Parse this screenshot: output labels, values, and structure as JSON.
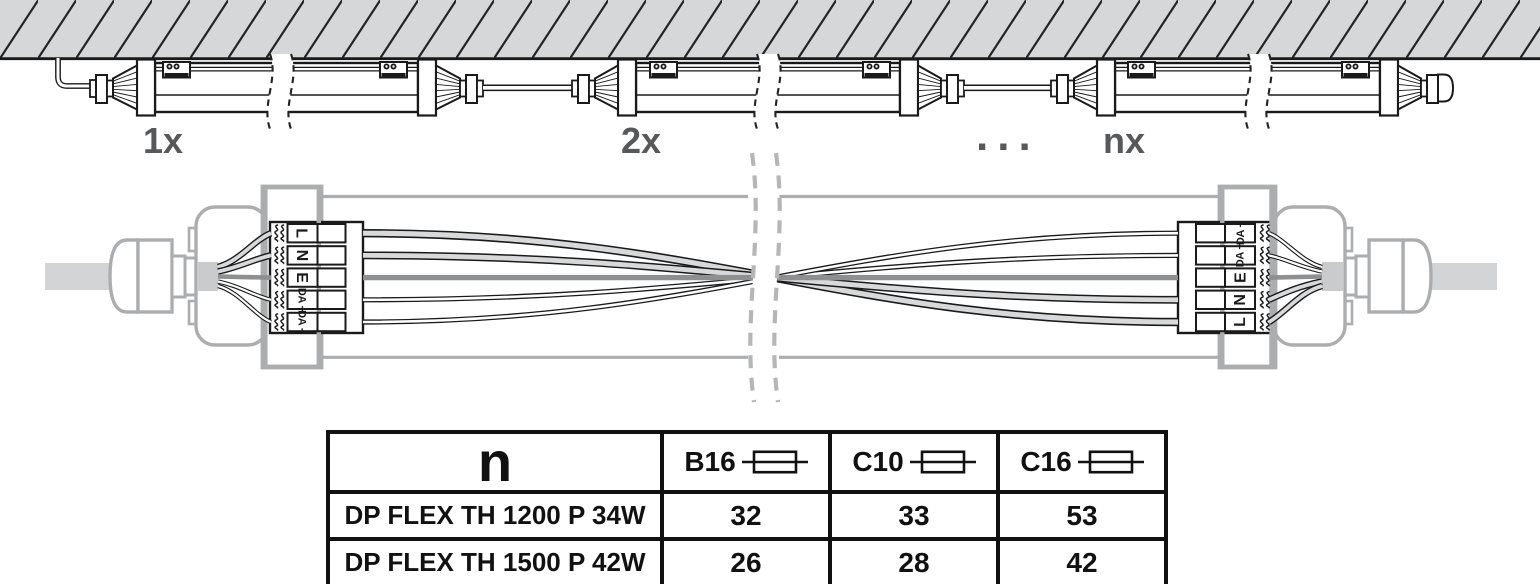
{
  "diagram": {
    "fixture_labels": {
      "first": "1x",
      "second": "2x",
      "ellipsis": "...",
      "nth": "nx"
    },
    "terminal_labels_left": [
      "L",
      "N",
      "E",
      "DA +",
      "DA −"
    ],
    "terminal_labels_right": [
      "DA −",
      "DA +",
      "E",
      "N",
      "L"
    ]
  },
  "table": {
    "header": {
      "n": "n",
      "fuses": [
        {
          "label": "B16"
        },
        {
          "label": "C10"
        },
        {
          "label": "C16"
        }
      ]
    },
    "rows": [
      {
        "name": "DP FLEX TH 1200 P 34W",
        "values": [
          "32",
          "33",
          "53"
        ]
      },
      {
        "name": "DP FLEX TH 1500 P 42W",
        "values": [
          "26",
          "28",
          "42"
        ]
      }
    ]
  },
  "colors": {
    "label_gray": "#57585a",
    "ceiling_gray": "#d6d7d8",
    "diagram_gray": "#abadaf",
    "wire_dark_gray": "#8e8f91",
    "line_black": "#1a1a1a"
  }
}
